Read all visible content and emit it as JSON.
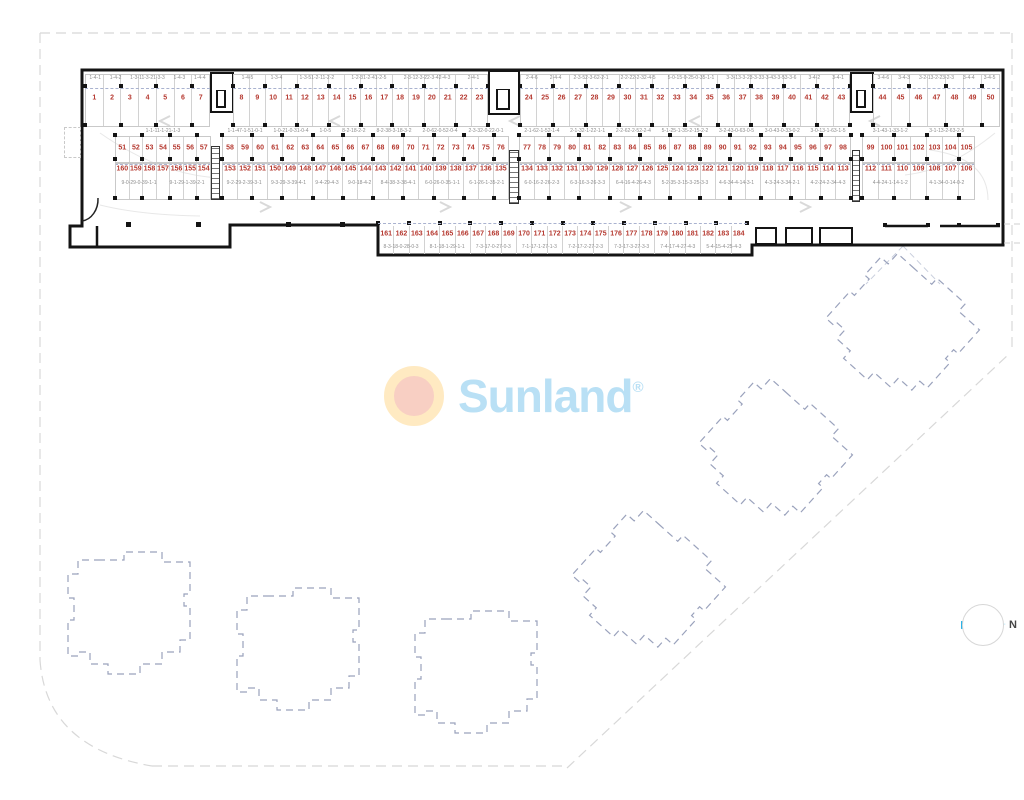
{
  "logo": {
    "text": "Sunland",
    "reg": "®"
  },
  "compass": {
    "label": "N"
  },
  "colors": {
    "space_number": "#b5382f",
    "unit_code": "#8d8d8d",
    "park_dash": "#a9b2cf",
    "wall": "#141414",
    "boundary": "#d8d8d8",
    "building_outline": "#9aa2bc",
    "logo_blue": "#b9e0f5",
    "sun_ring": "#ffeac2",
    "sun_core": "#f8cfc3",
    "needle": "#2ab3e8",
    "lane_arrow": "#d9d9d9"
  },
  "rows": {
    "A": {
      "groups": [
        {
          "from": 1,
          "to": 7,
          "codes": [
            "1-4-1",
            "1-4-2",
            "1-3-11-3-21-3-3",
            "1-4-3",
            "1-4-4"
          ]
        },
        {
          "from": 8,
          "to": 23,
          "codes": [
            "1-4-5",
            "1-3-4",
            "1-3-51-2-11-2-2",
            "1-2-31-2-41-2-5",
            "2-3-12-3-22-3-42-4-3",
            "2-4-1"
          ]
        },
        {
          "from": 24,
          "to": 43,
          "codes": [
            "2-4-6",
            "2-4-4",
            "2-3-52-3-62-2-1",
            "2-2-22-2-32-4-5",
            "5-0-15-0-25-0-35-1-1",
            "3-3-13-3-23-3-33-3-43-3-53-3-6",
            "3-4-2",
            "3-4-1"
          ]
        },
        {
          "from": 44,
          "to": 50,
          "codes": [
            "3-4-6",
            "3-4-3",
            "3-2-13-2-23-2-3",
            "3-4-4",
            "3-4-5"
          ]
        }
      ]
    },
    "B": {
      "groups": [
        {
          "from": 51,
          "to": 57,
          "codes": [
            "1-1-11-1-21-1-3"
          ]
        },
        {
          "from": 58,
          "to": 76,
          "codes": [
            "1-1-47-1-51-0-1",
            "1-0-21-0-31-0-4",
            "1-0-5",
            "8-2-18-2-2",
            "8-2-38-3-18-3-2",
            "2-0-62-0-52-0-4",
            "2-3-32-0-22-0-1"
          ]
        },
        {
          "from": 77,
          "to": 98,
          "codes": [
            "2-1-62-1-52-1-4",
            "2-1-32-1-22-1-1",
            "2-2-62-2-52-2-4",
            "5-1-25-1-35-2-15-2-2",
            "3-2-43-0-63-0-5",
            "3-0-43-0-33-0-2",
            "3-0-13-1-63-1-5"
          ]
        },
        {
          "from": 99,
          "to": 105,
          "codes": [
            "3-1-43-1-33-1-2",
            "3-1-13-2-63-2-5"
          ]
        }
      ]
    },
    "C": {
      "groups": [
        {
          "from": 160,
          "to": 154,
          "codes": [
            "9-0-29-0-39-1-1",
            "9-1-29-1-39-2-1"
          ]
        },
        {
          "from": 153,
          "to": 135,
          "codes": [
            "9-2-29-2-39-3-1",
            "9-3-29-3-39-4-1",
            "9-4-29-4-3",
            "9-0-18-4-2",
            "8-4-38-3-38-4-1",
            "6-0-26-0-35-1-1",
            "6-1-26-1-35-2-1"
          ]
        },
        {
          "from": 134,
          "to": 113,
          "codes": [
            "6-0-16-2-26-2-3",
            "6-3-16-3-26-3-3",
            "6-4-16-4-26-4-3",
            "5-2-35-3-15-3-25-3-3",
            "4-6-34-4-14-3-1",
            "4-3-24-3-34-2-1",
            "4-2-24-2-34-4-3"
          ]
        },
        {
          "from": 112,
          "to": 106,
          "codes": [
            "4-4-24-1-14-1-2",
            "4-1-34-0-14-0-2"
          ]
        }
      ]
    },
    "D": {
      "groups": [
        {
          "from": 161,
          "to": 184,
          "codes": [
            "8-3-18-0-28-0-3",
            "8-1-18-1-29-1-1",
            "7-3-17-0-27-0-3",
            "7-1-17-1-27-1-3",
            "7-2-17-2-27-2-3",
            "7-3-17-3-27-3-3",
            "7-4-17-4-27-4-3",
            "5-4-15-4-25-4-3"
          ]
        }
      ]
    }
  }
}
